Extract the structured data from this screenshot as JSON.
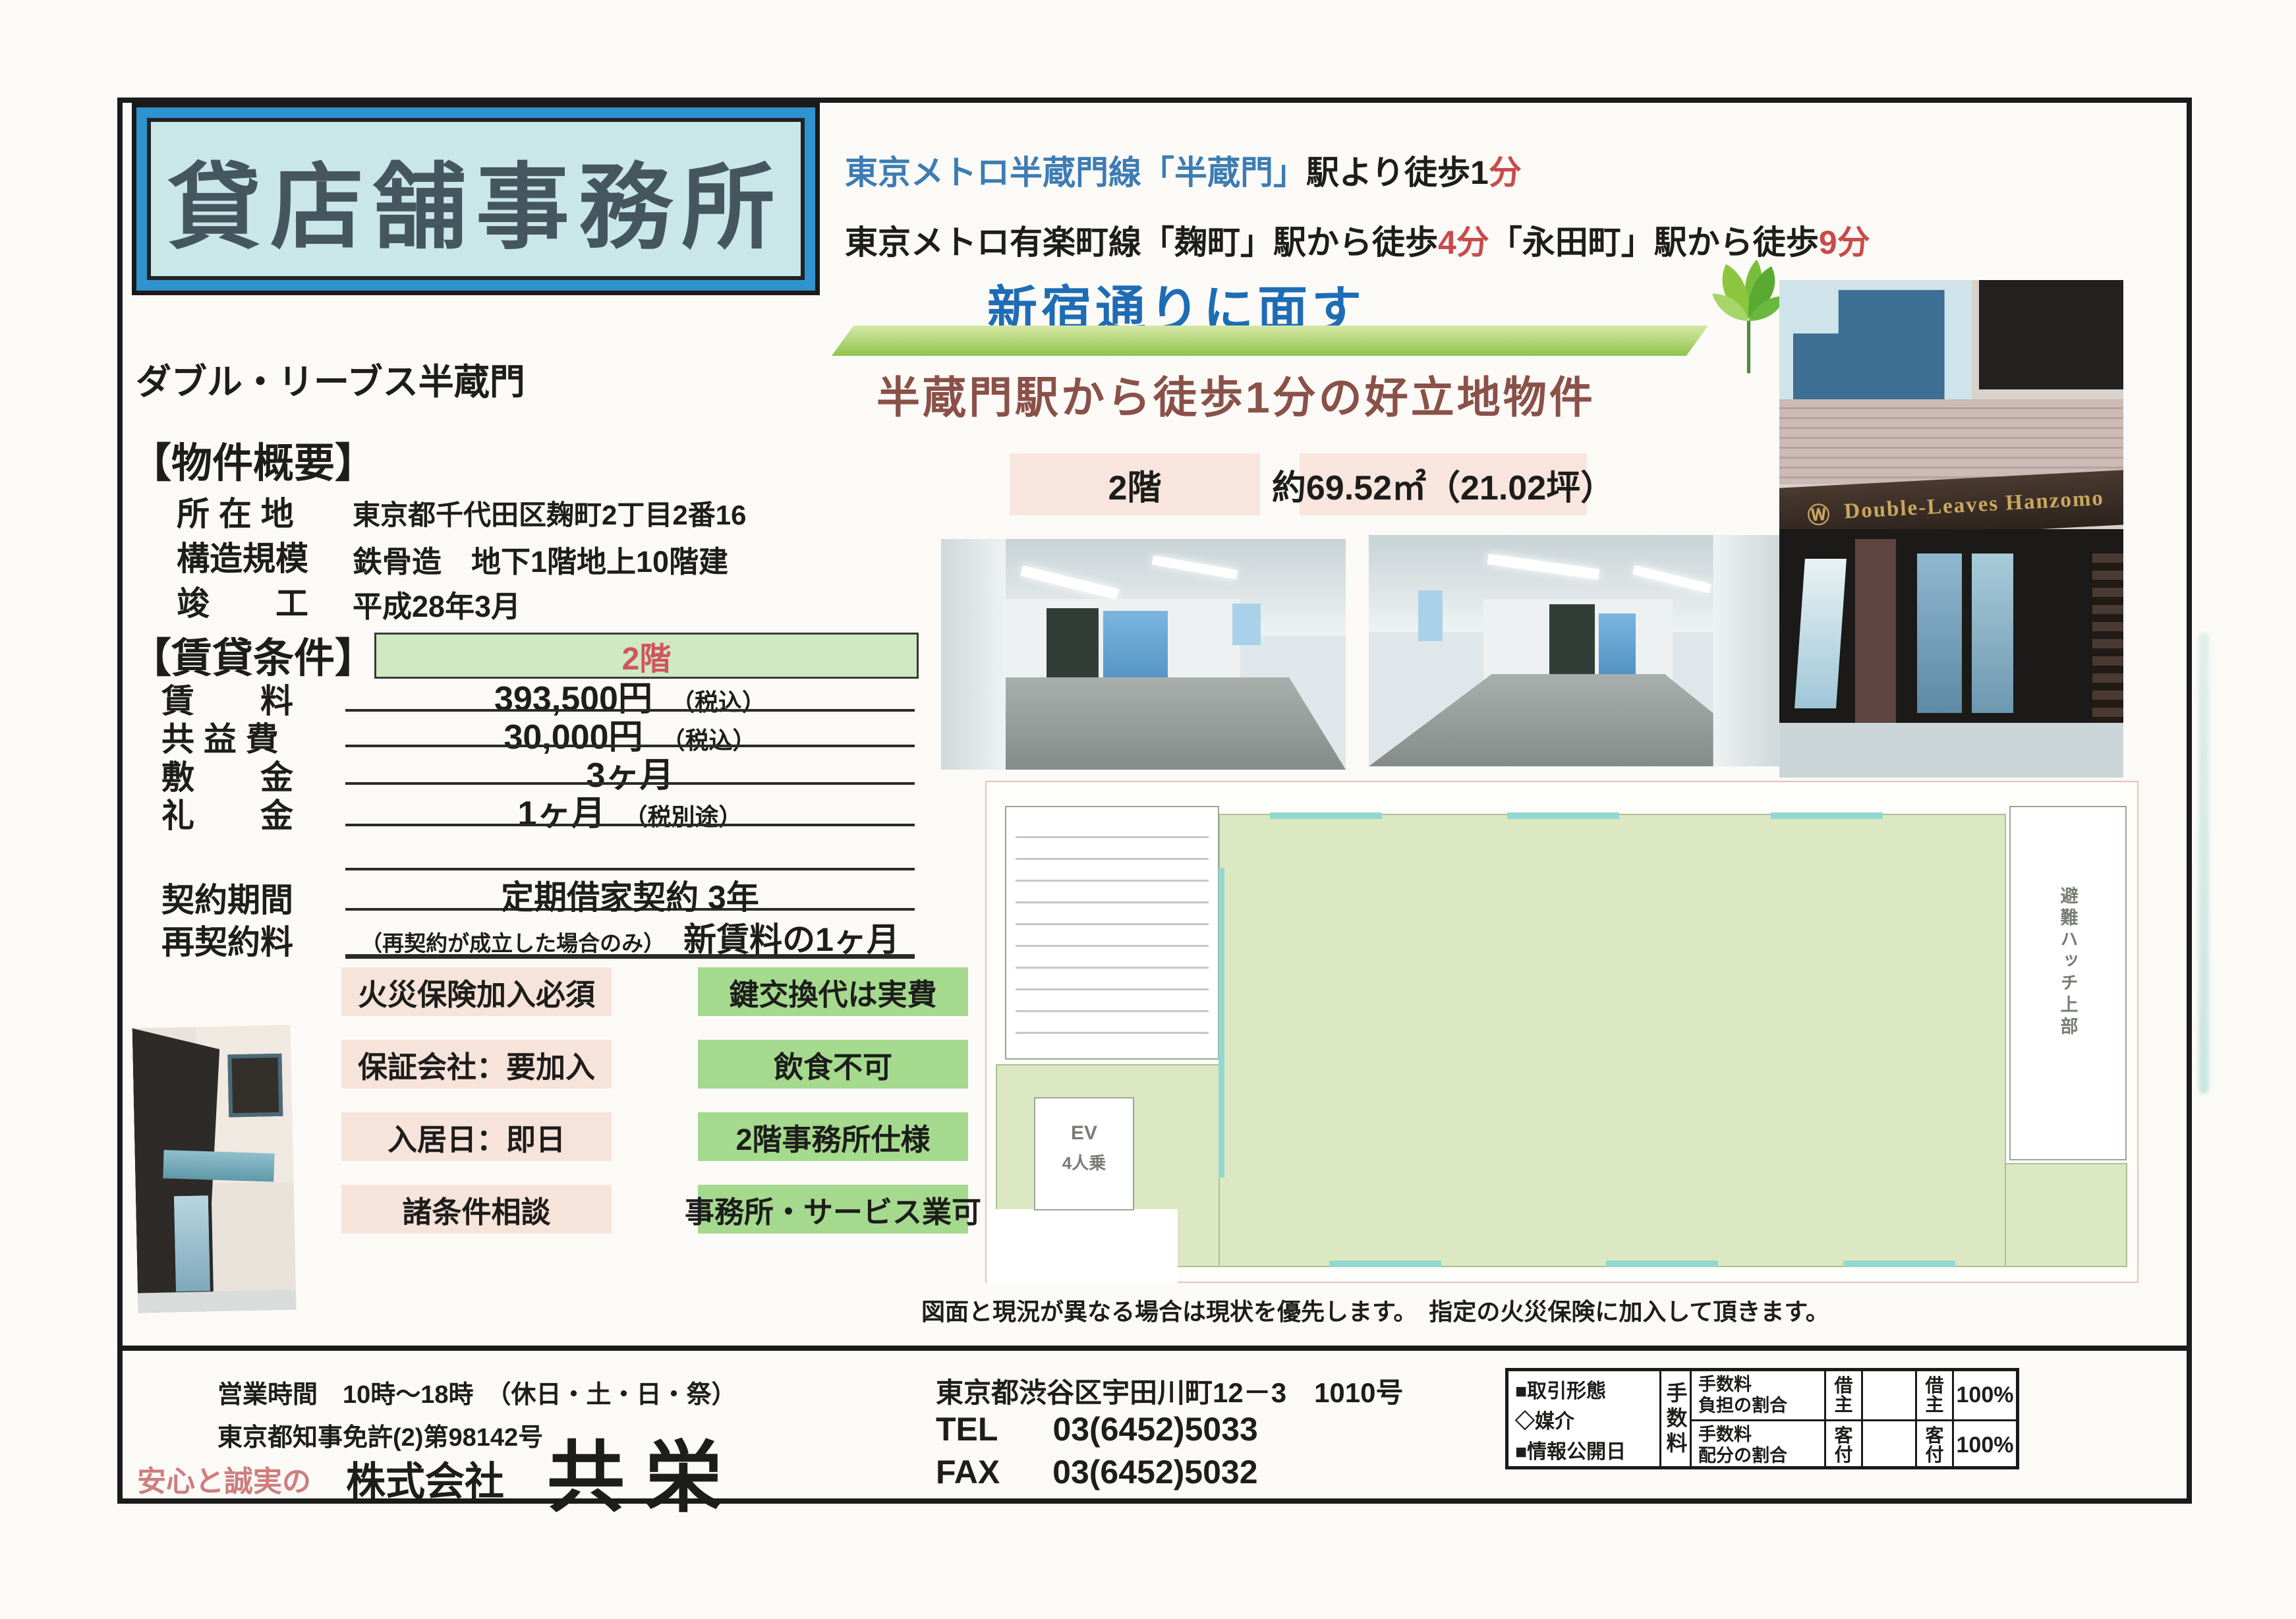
{
  "title_box": {
    "title": "貸店舗事務所"
  },
  "access": {
    "line1_blue": "東京メトロ半蔵門線「半蔵門」",
    "line1_black": "駅より徒歩1",
    "line1_red": "分",
    "line2_black1": "東京メトロ有楽町線「麹町」駅から徒歩",
    "line2_red1": "4分",
    "line2_black2": "「永田町」駅から徒歩",
    "line2_red2": "9分"
  },
  "catch": {
    "banner": "新宿通りに面す",
    "sub": "半蔵門駅から徒歩1分の好立地物件"
  },
  "building_name": "ダブル・リーブス半蔵門",
  "overview": {
    "heading": "【物件概要】",
    "rows": [
      {
        "label": "所 在 地",
        "value": "東京都千代田区麹町2丁目2番16"
      },
      {
        "label": "構造規模",
        "value": "鉄骨造　地下1階地上10階建"
      },
      {
        "label": "竣　　工",
        "value": "平成28年3月"
      }
    ]
  },
  "terms": {
    "heading": "【賃貸条件】",
    "floor_bar": "2階",
    "rows": [
      {
        "label": "賃　　料",
        "value": "393,500円",
        "note": "（税込）"
      },
      {
        "label": "共 益 費",
        "value": "30,000円",
        "note": "（税込）"
      },
      {
        "label": "敷　　金",
        "value": "3ヶ月",
        "note": ""
      },
      {
        "label": "礼　　金",
        "value": "1ヶ月",
        "note": "（税別途）"
      }
    ],
    "contract": [
      {
        "label": "契約期間",
        "pre": "",
        "value": "定期借家契約 3年"
      },
      {
        "label": "再契約料",
        "pre": "（再契約が成立した場合のみ）",
        "value": "新賃料の1ヶ月"
      }
    ]
  },
  "badges": {
    "pink": [
      "火災保険加入必須",
      "保証会社：要加入",
      "入居日：即日",
      "諸条件相談"
    ],
    "green": [
      "鍵交換代は実費",
      "飲食不可",
      "2階事務所仕様",
      "事務所・サービス業可"
    ]
  },
  "unit": {
    "floor": "2階",
    "area": "約69.52㎡（21.02坪）"
  },
  "photos": {
    "building_sign_logo": "Ⓦ",
    "building_sign": "Double-Leaves Hanzomo"
  },
  "floorplan": {
    "ev_line1": "EV",
    "ev_line2": "4人乗",
    "hatch_label": "避難ハッチ上部",
    "caption": "図面と現況が異なる場合は現状を優先します。　指定の火災保険に加入して頂きます。"
  },
  "footer": {
    "hours": "営業時間　10時～18時　（休日・土・日・祭）",
    "license": "東京都知事免許(2)第98142号",
    "tagline": "安心と誠実の",
    "company_prefix": "株式会社",
    "company_name": "共栄",
    "address": "東京都渋谷区宇田川町12－3　1010号",
    "tel_label": "TEL",
    "tel_number": "03(6452)5033",
    "fax_label": "FAX",
    "fax_number": "03(6452)5032"
  },
  "deal_table": {
    "left_lines": [
      "■取引形態",
      "◇媒介",
      "■情報公開日"
    ],
    "fee_header": "手数料",
    "rows": [
      {
        "item_l1": "手数料",
        "item_l2": "負担の割合",
        "party_a": "借主",
        "party_b": "借主",
        "pct": "100%"
      },
      {
        "item_l1": "手数料",
        "item_l2": "配分の割合",
        "party_a": "客付",
        "party_b": "客付",
        "pct": "100%"
      }
    ]
  },
  "colors": {
    "title_bg": "#c9e6e8",
    "title_frame": "#2e93cf",
    "access_blue": "#3d7cb3",
    "highlight_red": "#c94a4a",
    "banner_blue": "#1e6cb5",
    "swoosh_green": "#8cc341",
    "catch_brown": "#8a5149",
    "badge_pink_bg": "#f6e3da",
    "badge_green_bg": "#a5da8e",
    "terms_bar_bg": "#cfe9c2",
    "terms_bar_text": "#cf5560",
    "floorplan_green": "#dbe8c2"
  }
}
